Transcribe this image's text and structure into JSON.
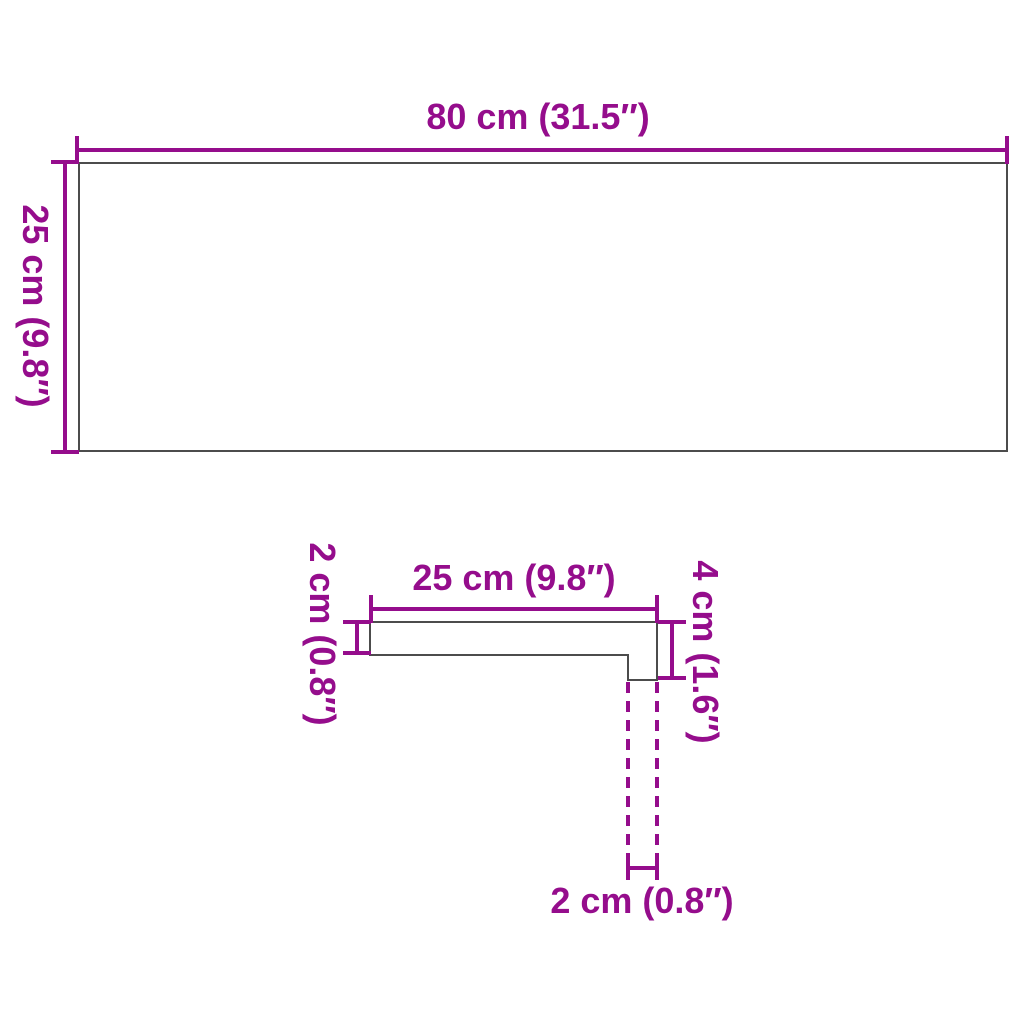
{
  "colors": {
    "accent": "#950d8c",
    "outline": "#4c4c4c",
    "background": "#ffffff"
  },
  "board_diagram": {
    "width_label": "80 cm (31.5″)",
    "height_label": "25 cm (9.8″)"
  },
  "profile_diagram": {
    "depth_label": "25 cm (9.8″)",
    "thickness_label": "2 cm (0.8″)",
    "nose_height_label": "4 cm (1.6″)",
    "nose_width_label": "2 cm (0.8″)"
  }
}
